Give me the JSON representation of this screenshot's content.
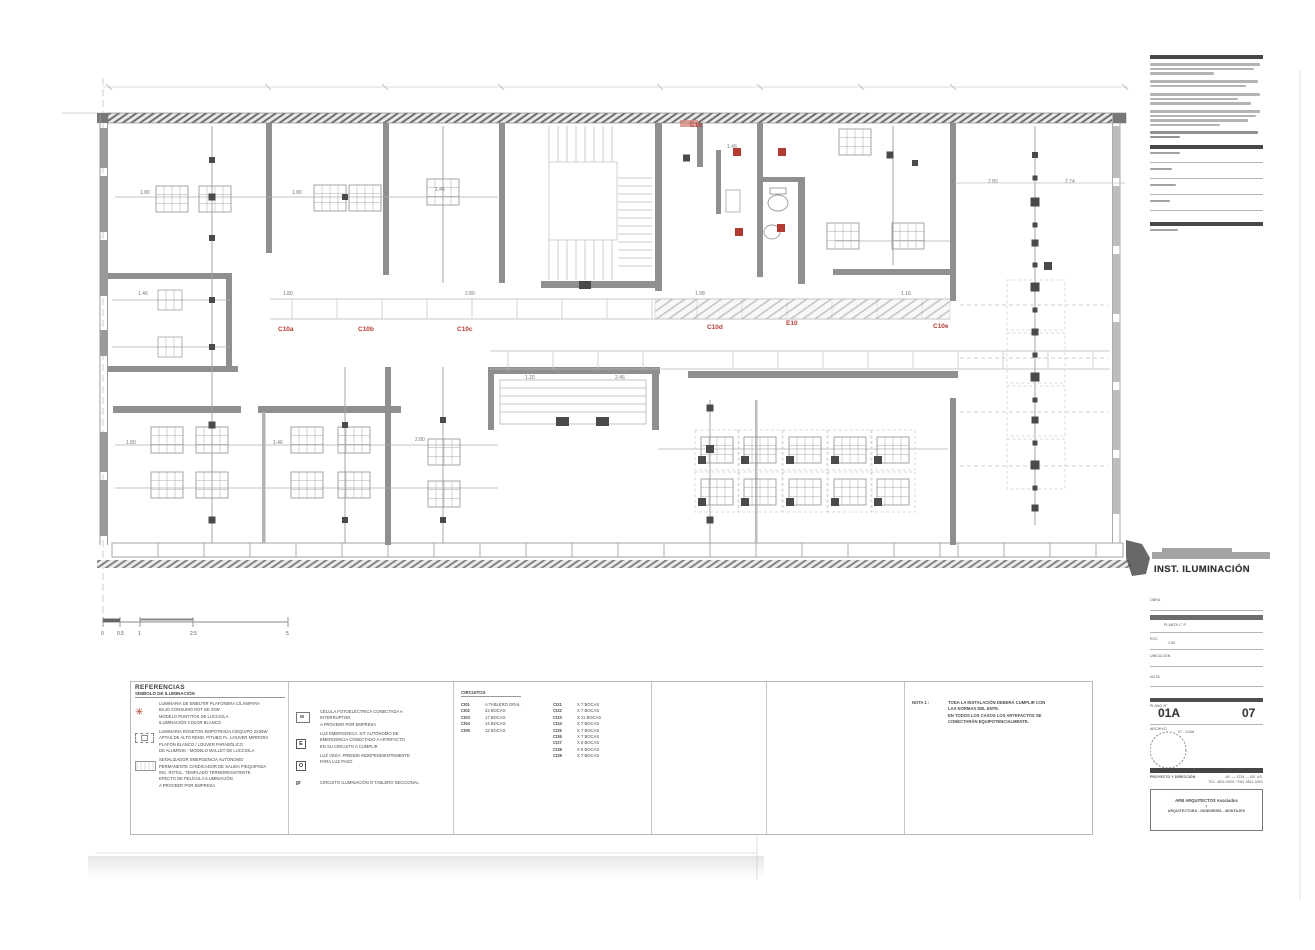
{
  "plan": {
    "tags": [
      {
        "t": "C10"
      },
      {
        "t": "C10a"
      },
      {
        "t": "C10b"
      },
      {
        "t": "C10c"
      },
      {
        "t": "C10d"
      },
      {
        "t": "E10"
      },
      {
        "t": "C10e"
      }
    ],
    "dims": [
      {
        "t": "1.80"
      },
      {
        "t": "1.80"
      },
      {
        "t": "1.46"
      },
      {
        "t": "1.46"
      },
      {
        "t": "1.80"
      },
      {
        "t": "2.80"
      },
      {
        "t": "1.98"
      },
      {
        "t": "1.16"
      },
      {
        "t": "2.80"
      },
      {
        "t": "2.74"
      },
      {
        "t": "1.80"
      },
      {
        "t": "1.46"
      },
      {
        "t": "2.80"
      },
      {
        "t": "1.46"
      },
      {
        "t": "1.20"
      },
      {
        "t": "2.46"
      }
    ],
    "scale_labels": [
      "0",
      "0.5",
      "1",
      "2.5",
      "5"
    ]
  },
  "legend": {
    "header": "REFERENCIAS",
    "subheader": "SÍMBOLO DE ILUMINACIÓN",
    "col1": [
      {
        "lines": [
          "LUMINARIA DE EMBUTIR PLAFONERA C/LÁMPARA",
          "BAJO CONSUMO ROT DE 20W",
          "MODELO PUNTITOS DE LUCCIOLA",
          "ILUMINACIÓN COLOR BLANCO"
        ]
      },
      {
        "lines": [
          "LUMINARIA ROSETÓN EMPOTRADA C/EQUIPO 2X36W",
          "APTAS DE ALTO REND. P/TUBO FL. LOUVER MIRROR4",
          "PLAFÓN BLANCO / LOUVER PARABÓLICO",
          "DE ALUMINIO - MODELO MALLET DE LUCCIOLA"
        ]
      },
      {
        "lines": [
          "SEÑALIZADOR EMERGENCIA AUTÓNOMO",
          "PERMANENTE C/INDICADOR DE SALIDA P/EQUIPADA",
          "INC. ROTUL. TEMPLADO TERMORESISTENTE",
          "EFECTO DE PELÍCULA ILUMINACIÓN",
          "A PROVEER POR EMPRESA"
        ]
      }
    ],
    "col2": [
      {
        "sym": "CF",
        "lines": [
          "CÉLULA FOTOELÉCTRICA CONECTADA A",
          "INTERRUPTOR.",
          "A PROVEER POR EMPRESA"
        ]
      },
      {
        "sym": "E",
        "lines": [
          "LUZ EMERGENCIA. KIT AUTÓNOMO DE",
          "EMERGENCIA CONECTADO A ARTEFACTO",
          "EN SU CIRCUITO A CUMPLIR"
        ]
      },
      {
        "sym": "O",
        "lines": [
          "LUZ VIGÍA. PRENDE INDEPENDIENTEMENTE",
          "PARA LUZ PASO"
        ]
      },
      {
        "sym": "IP",
        "lines": [
          "CIRCUITO ILUMINACIÓN O TABLERO SECCIONAL"
        ]
      }
    ],
    "circuits": {
      "header": "CIRCUITOS",
      "left": [
        [
          "CI01",
          "A TABLERO GRAL"
        ],
        [
          "CI02",
          "22 BOCAS"
        ],
        [
          "CI03",
          "17 BOCAS"
        ],
        [
          "CI04",
          "14 BOCAS"
        ],
        [
          "CI05",
          "12 BOCAS"
        ]
      ],
      "right": [
        [
          "CI21",
          "X 7 BOCAS"
        ],
        [
          "CI22",
          "X 7 BOCAS"
        ],
        [
          "CI23",
          "X 11 BOCAS"
        ],
        [
          "CI24",
          "X 7 BOCAS"
        ],
        [
          "CI25",
          "X 7 BOCAS"
        ],
        [
          "CI26",
          "X 7 BOCAS"
        ],
        [
          "CI27",
          "X 8 BOCAS"
        ],
        [
          "CI28",
          "X 6 BOCAS"
        ],
        [
          "CI29",
          "X 7 BOCAS"
        ]
      ]
    },
    "nota_label": "NOTA 1 :",
    "nota_lines": [
      "TODA LA INSTALACIÓN DEBERÁ CUMPLIR CON",
      "LAS NORMAS DEL ENTE.",
      "EN TODOS LOS CASOS LOS ARTEFACTOS SE",
      "CONECTARÁN EQUIPOTENCIALMENTE."
    ]
  },
  "panel": {
    "title": "INST. ILUMINACIÓN",
    "fields": [
      {
        "label": "OBRA",
        "value": ""
      },
      {
        "label": "PLANO",
        "value": "PLANTA 1° P."
      },
      {
        "label": "ESC.",
        "value": "1:50"
      },
      {
        "label": "UBICACIÓN",
        "value": ""
      },
      {
        "label": "NOTA",
        "value": ""
      }
    ],
    "sheet_label": "PLANO N°",
    "sheet_code": "01A",
    "sheet_number": "07",
    "file_row": {
      "label": "ARCHIVO",
      "value": "07 - ILUM"
    },
    "firm_bar_label": "PROYECTO Y DIRECCIÓN",
    "firm_right": [
      "AV. — 1234 — BS. AS.",
      "TEL. 4811-0000 / FAX 4811-0001"
    ],
    "firm_box": [
      "ARB ARQUITECTOS Asociados",
      "y",
      "ARQUITECTURA - INGENIERÍA - MONTAJES"
    ]
  }
}
